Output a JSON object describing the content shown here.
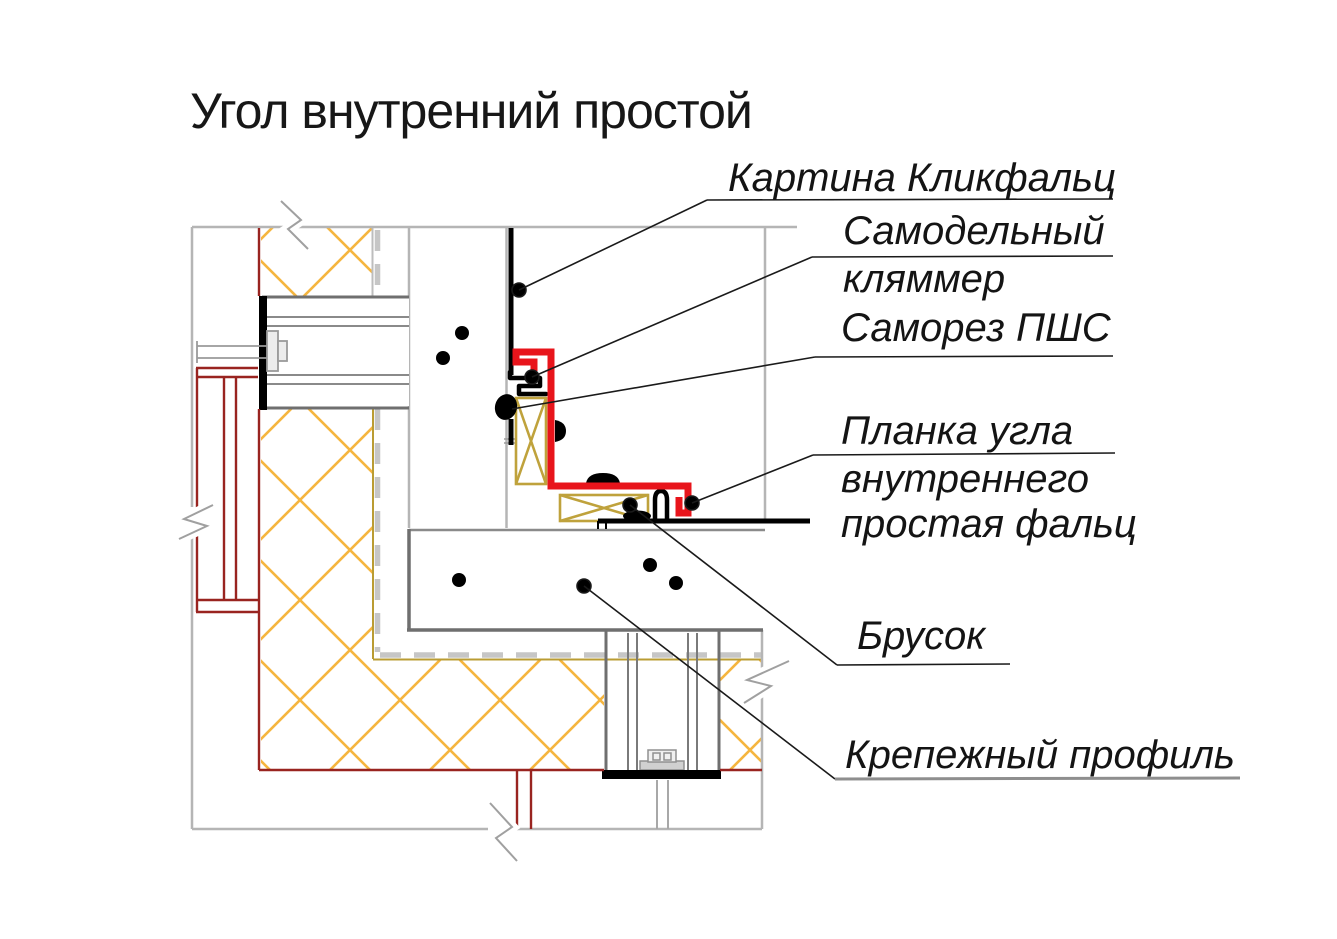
{
  "title": "Угол внутренний простой",
  "callouts": {
    "kartina": {
      "text": "Картина Кликфальц"
    },
    "samodelny": {
      "line1": "Самодельный",
      "line2": "кляммер"
    },
    "samorez": {
      "text": "Саморез ПШС"
    },
    "planka": {
      "line1": "Планка угла",
      "line2": "внутреннего",
      "line3": "простая фальц"
    },
    "brusok": {
      "text": "Брусок"
    },
    "krepezh": {
      "text": "Крепежный профиль"
    }
  },
  "colors": {
    "flashing_red": "#e8141b",
    "wall_profile_maroon": "#992420",
    "insulation_hatch_yellow": "#f5b53f",
    "insulation_border_olive": "#ba9c33",
    "structure_light_gray": "#b5b5b5",
    "structure_dark_gray": "#6f6f6f",
    "panel_black": "#000000",
    "text_color": "#141414"
  }
}
